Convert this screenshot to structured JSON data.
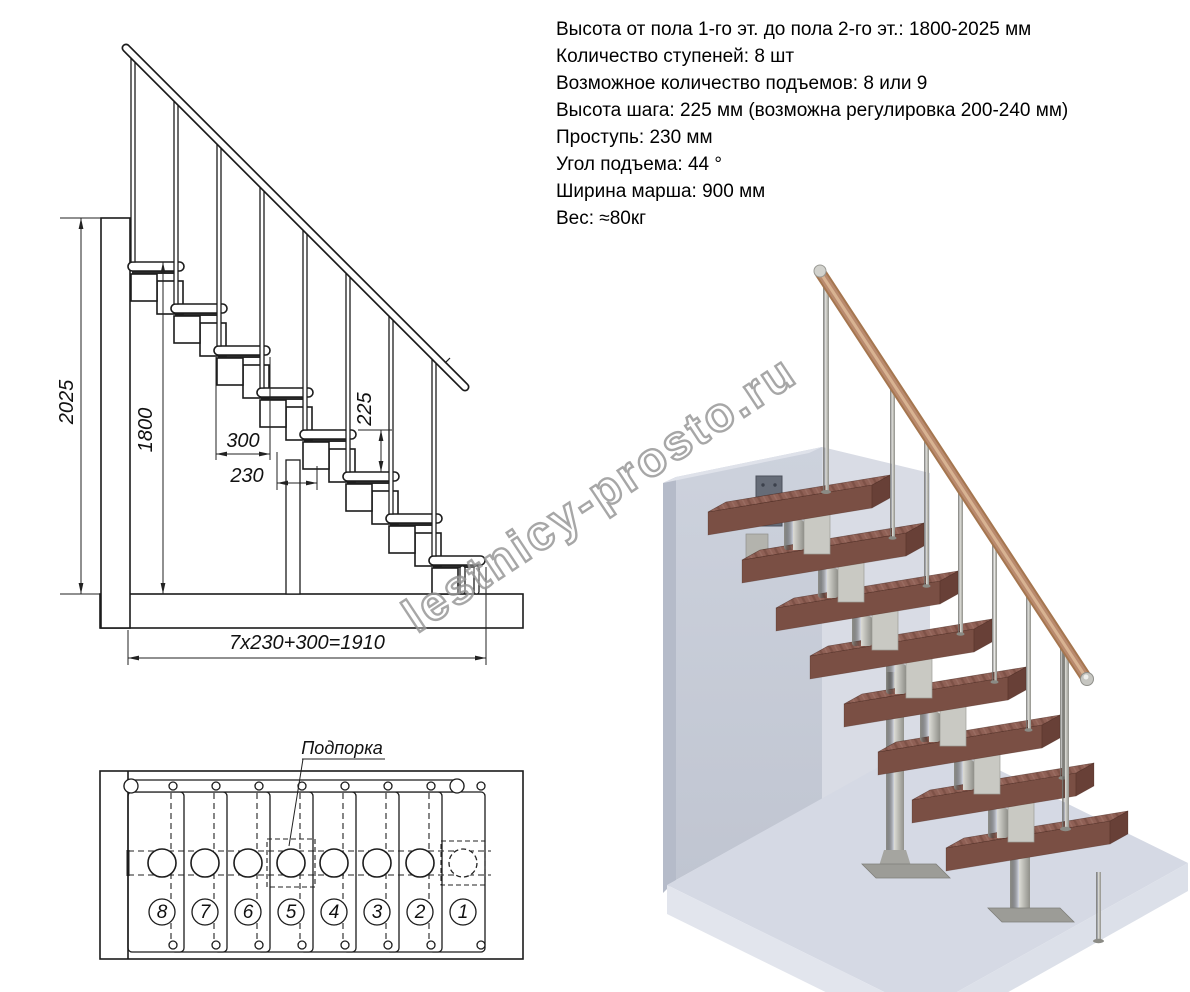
{
  "specs": {
    "lines": [
      "Высота от пола 1-го эт. до пола 2-го эт.: 1800-2025 мм",
      "Количество ступеней: 8 шт",
      "Возможное количество подъемов: 8 или 9",
      "Высота шага: 225 мм (возможна регулировка 200-240 мм)",
      "Проступь: 230 мм",
      "Угол подъема: 44 °",
      "Ширина марша: 900 мм",
      "Вес: ≈80кг"
    ]
  },
  "side_view": {
    "dims": {
      "total_height": "2025",
      "clear_height": "1800",
      "tread_depth": "300",
      "going": "230",
      "rise": "225",
      "total_run": "7x230+300=1910"
    }
  },
  "plan_view": {
    "support_label": "Подпорка",
    "step_numbers": [
      "8",
      "7",
      "6",
      "5",
      "4",
      "3",
      "2",
      "1"
    ]
  },
  "watermark": {
    "text": "lestnicy-prosto.ru"
  },
  "colors": {
    "tread_wood": "#8f6055",
    "tread_wood_front": "#7a4f44",
    "handrail_wood": "#b98a6e",
    "metal": "#c0c0ba",
    "wall": "#c9ceda",
    "floor": "#d5d9e4",
    "line": "#1c1c1c"
  }
}
